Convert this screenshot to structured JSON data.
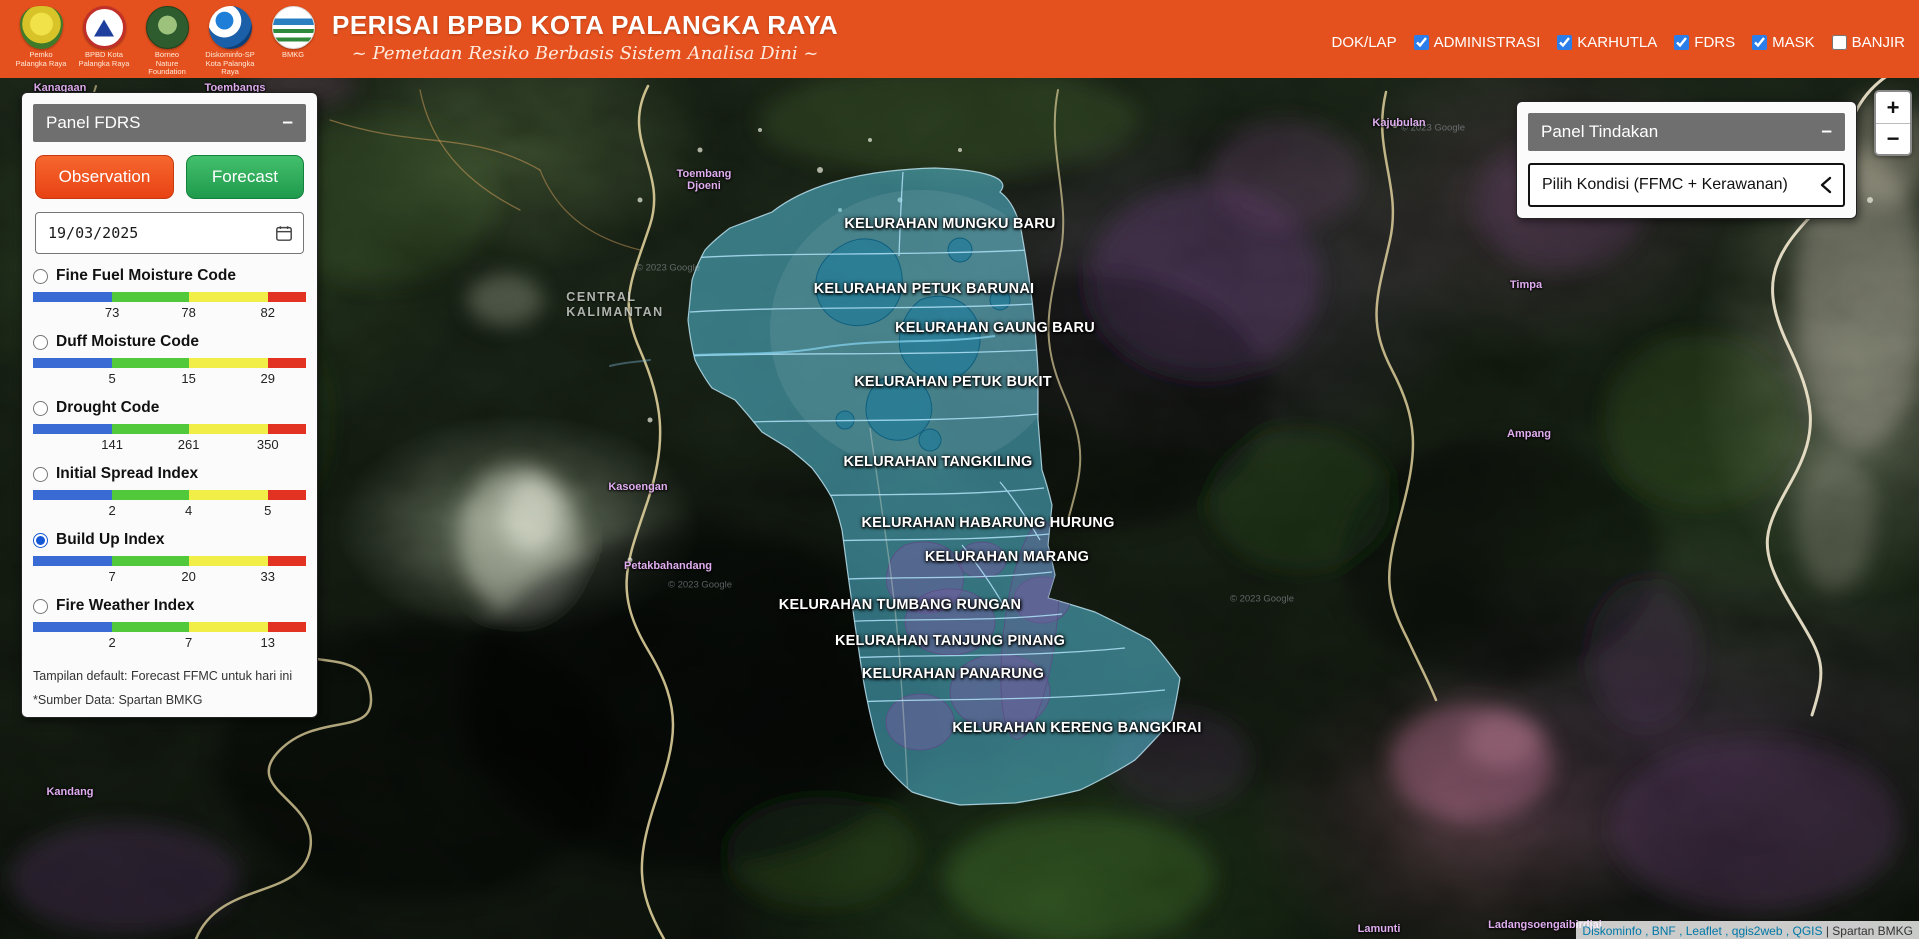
{
  "header": {
    "title": "PERISAI BPBD KOTA PALANGKA RAYA",
    "subtitle": "~ Pemetaan Resiko Berbasis Sistem Analisa Dini ~",
    "logos": [
      {
        "id": "pemko",
        "caption": "Pemko\nPalangka Raya"
      },
      {
        "id": "bpbd",
        "caption": "BPBD Kota\nPalangka Raya"
      },
      {
        "id": "bnf",
        "caption": "Borneo\nNature\nFoundation"
      },
      {
        "id": "diskominfo",
        "caption": "Diskominfo-SP\nKota Palangka Raya"
      },
      {
        "id": "bmkg",
        "caption": "BMKG"
      }
    ],
    "nav": [
      {
        "label": "DOK/LAP",
        "has_checkbox": false,
        "checked": false
      },
      {
        "label": "ADMINISTRASI",
        "has_checkbox": true,
        "checked": true
      },
      {
        "label": "KARHUTLA",
        "has_checkbox": true,
        "checked": true
      },
      {
        "label": "FDRS",
        "has_checkbox": true,
        "checked": true
      },
      {
        "label": "MASK",
        "has_checkbox": true,
        "checked": true
      },
      {
        "label": "BANJIR",
        "has_checkbox": true,
        "checked": false
      }
    ]
  },
  "fdrs_panel": {
    "title": "Panel FDRS",
    "collapse_label": "–",
    "observation_label": "Observation",
    "forecast_label": "Forecast",
    "date_value": "19/03/2025",
    "scale_colors": [
      "#3a6ad4",
      "#52c93a",
      "#f1ee48",
      "#e23222"
    ],
    "indices": [
      {
        "label": "Fine Fuel Moisture Code",
        "selected": false,
        "thresholds": [
          "73",
          "78",
          "82"
        ]
      },
      {
        "label": "Duff Moisture Code",
        "selected": false,
        "thresholds": [
          "5",
          "15",
          "29"
        ]
      },
      {
        "label": "Drought Code",
        "selected": false,
        "thresholds": [
          "141",
          "261",
          "350"
        ]
      },
      {
        "label": "Initial Spread Index",
        "selected": false,
        "thresholds": [
          "2",
          "4",
          "5"
        ]
      },
      {
        "label": "Build Up Index",
        "selected": true,
        "thresholds": [
          "7",
          "20",
          "33"
        ]
      },
      {
        "label": "Fire Weather Index",
        "selected": false,
        "thresholds": [
          "2",
          "7",
          "13"
        ]
      }
    ],
    "footnote1": "Tampilan default: Forecast FFMC untuk hari ini",
    "footnote2": "*Sumber Data: Spartan BMKG"
  },
  "tindakan_panel": {
    "title": "Panel Tindakan",
    "collapse_label": "–",
    "dropdown_label": "Pilih Kondisi (FFMC + Kerawanan)"
  },
  "map_controls": {
    "zoom_in": "+",
    "zoom_out": "−"
  },
  "map": {
    "region_label": "CENTRAL\nKALIMANTAN",
    "google_credit": "© 2023 Google",
    "attribution_links": "Diskominfo , BNF , Leaflet , qgis2web , QGIS ",
    "attribution_suffix": "| Spartan BMKG",
    "kelurahan_labels": [
      {
        "name": "KELURAHAN MUNGKU BARU",
        "x": 950,
        "y": 224
      },
      {
        "name": "KELURAHAN PETUK BARUNAI",
        "x": 924,
        "y": 289
      },
      {
        "name": "KELURAHAN GAUNG BARU",
        "x": 995,
        "y": 328
      },
      {
        "name": "KELURAHAN PETUK BUKIT",
        "x": 953,
        "y": 382
      },
      {
        "name": "KELURAHAN TANGKILING",
        "x": 938,
        "y": 462
      },
      {
        "name": "KELURAHAN HABARUNG HURUNG",
        "x": 988,
        "y": 523
      },
      {
        "name": "KELURAHAN MARANG",
        "x": 1007,
        "y": 557
      },
      {
        "name": "KELURAHAN TUMBANG RUNGAN",
        "x": 900,
        "y": 605
      },
      {
        "name": "KELURAHAN TANJUNG PINANG",
        "x": 950,
        "y": 641
      },
      {
        "name": "KELURAHAN PANARUNG",
        "x": 953,
        "y": 674
      },
      {
        "name": "KELURAHAN KERENG BANGKIRAI",
        "x": 1077,
        "y": 728
      }
    ],
    "place_labels": [
      {
        "name": "Toembang\nDjoeni",
        "x": 704,
        "y": 180
      },
      {
        "name": "Kasoengan",
        "x": 638,
        "y": 487
      },
      {
        "name": "Petakbahandang",
        "x": 668,
        "y": 566
      },
      {
        "name": "Kajubulan",
        "x": 1399,
        "y": 123
      },
      {
        "name": "Timpa",
        "x": 1526,
        "y": 285
      },
      {
        "name": "Ampang",
        "x": 1529,
        "y": 434
      },
      {
        "name": "Kandang",
        "x": 70,
        "y": 792
      },
      {
        "name": "Lamunti",
        "x": 1379,
        "y": 929
      },
      {
        "name": "Ladangsoengaibirdjai",
        "x": 1545,
        "y": 925
      },
      {
        "name": "Kanagaan",
        "x": 60,
        "y": 88
      },
      {
        "name": "Toembangs",
        "x": 235,
        "y": 88
      }
    ],
    "credit_positions": [
      {
        "x": 668,
        "y": 268
      },
      {
        "x": 700,
        "y": 585
      },
      {
        "x": 1433,
        "y": 128
      },
      {
        "x": 1262,
        "y": 599
      }
    ]
  }
}
